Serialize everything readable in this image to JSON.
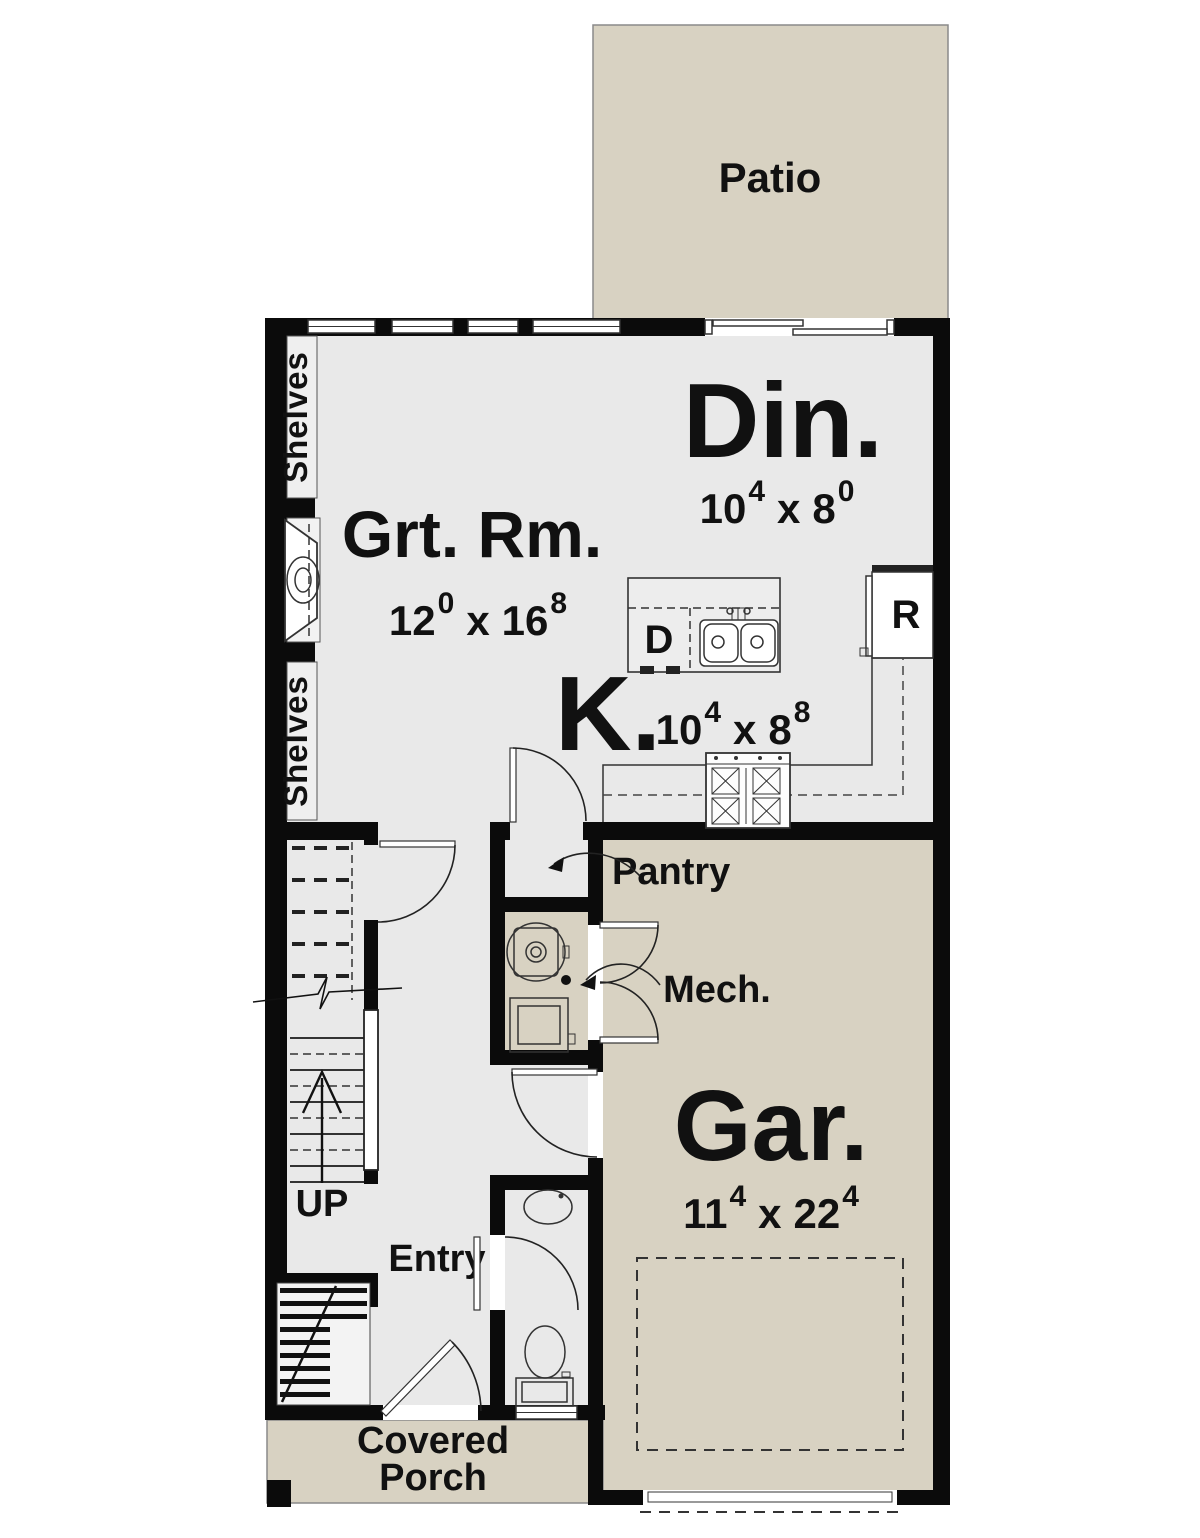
{
  "colors": {
    "floor": "#e9e9e9",
    "outdoor": "#d8d2c2",
    "wall": "#0b0b0b",
    "text": "#111111"
  },
  "sep": "x",
  "rooms": {
    "patio": {
      "label": "Patio"
    },
    "dining": {
      "label": "Din.",
      "dim": {
        "w_ft": "10",
        "w_in": "4",
        "l_ft": "8",
        "l_in": "0"
      }
    },
    "great_room": {
      "label": "Grt. Rm.",
      "dim": {
        "w_ft": "12",
        "w_in": "0",
        "l_ft": "16",
        "l_in": "8"
      }
    },
    "kitchen": {
      "label": "K.",
      "dim": {
        "w_ft": "10",
        "w_in": "4",
        "l_ft": "8",
        "l_in": "8"
      }
    },
    "garage": {
      "label": "Gar.",
      "dim": {
        "w_ft": "11",
        "w_in": "4",
        "l_ft": "22",
        "l_in": "4"
      }
    },
    "pantry": {
      "label": "Pantry"
    },
    "mech": {
      "label": "Mech."
    },
    "entry": {
      "label": "Entry"
    },
    "stairs": {
      "label": "UP"
    },
    "porch": {
      "label_line1": "Covered",
      "label_line2": "Porch"
    },
    "shelves_upper": {
      "label": "Shelves"
    },
    "shelves_lower": {
      "label": "Shelves"
    }
  },
  "appliances": {
    "refrigerator_label": "R",
    "dishwasher_label": "D"
  }
}
